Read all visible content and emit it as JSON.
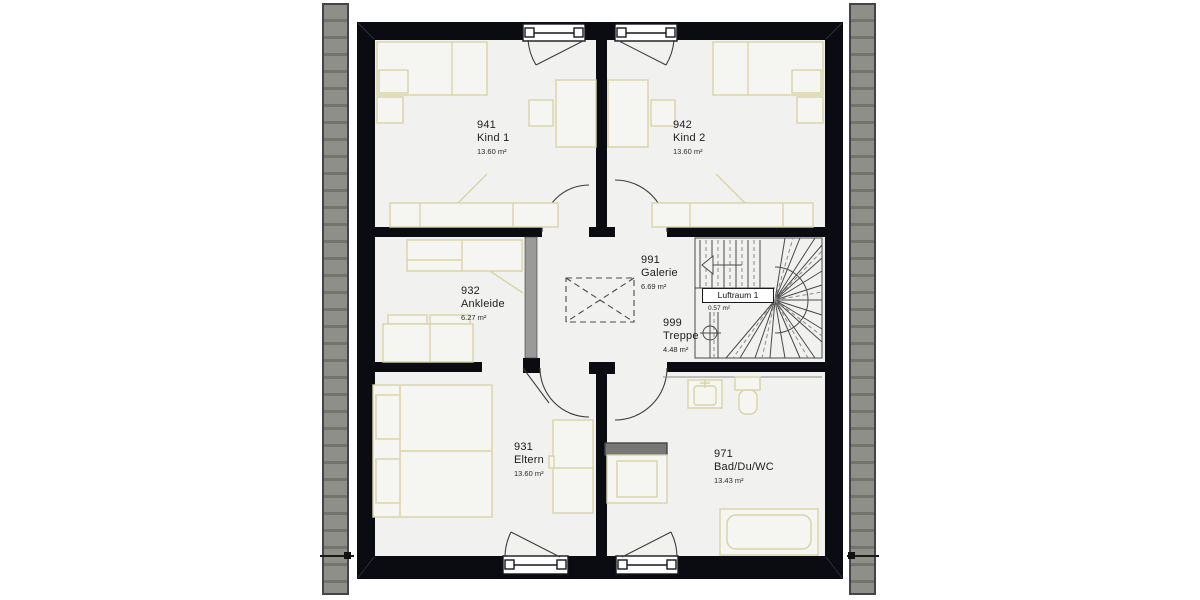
{
  "plan_title": "Obergeschoss Grundriss",
  "rooms": [
    {
      "id": "941",
      "name": "Kind 1",
      "area": "13.60 m²"
    },
    {
      "id": "942",
      "name": "Kind 2",
      "area": "13.60 m²"
    },
    {
      "id": "932",
      "name": "Ankleide",
      "area": "6.27 m²"
    },
    {
      "id": "991",
      "name": "Galerie",
      "area": "6.69 m²"
    },
    {
      "id": "999",
      "name": "Treppe",
      "area": "4.48 m²"
    },
    {
      "id": "931",
      "name": "Eltern",
      "area": "13.60 m²"
    },
    {
      "id": "971",
      "name": "Bad/Du/WC",
      "area": "13.43 m²"
    }
  ],
  "void_label": {
    "name": "Luftraum 1",
    "area": "0.57 m²"
  },
  "colors": {
    "wall": "#0b0b12",
    "floor": "#f1f1ef",
    "furniture_line": "#d8d4a6",
    "roof_strip": "#8f8f89",
    "partition_gray": "#9a9a98",
    "stair_line": "#4a4a4a"
  }
}
